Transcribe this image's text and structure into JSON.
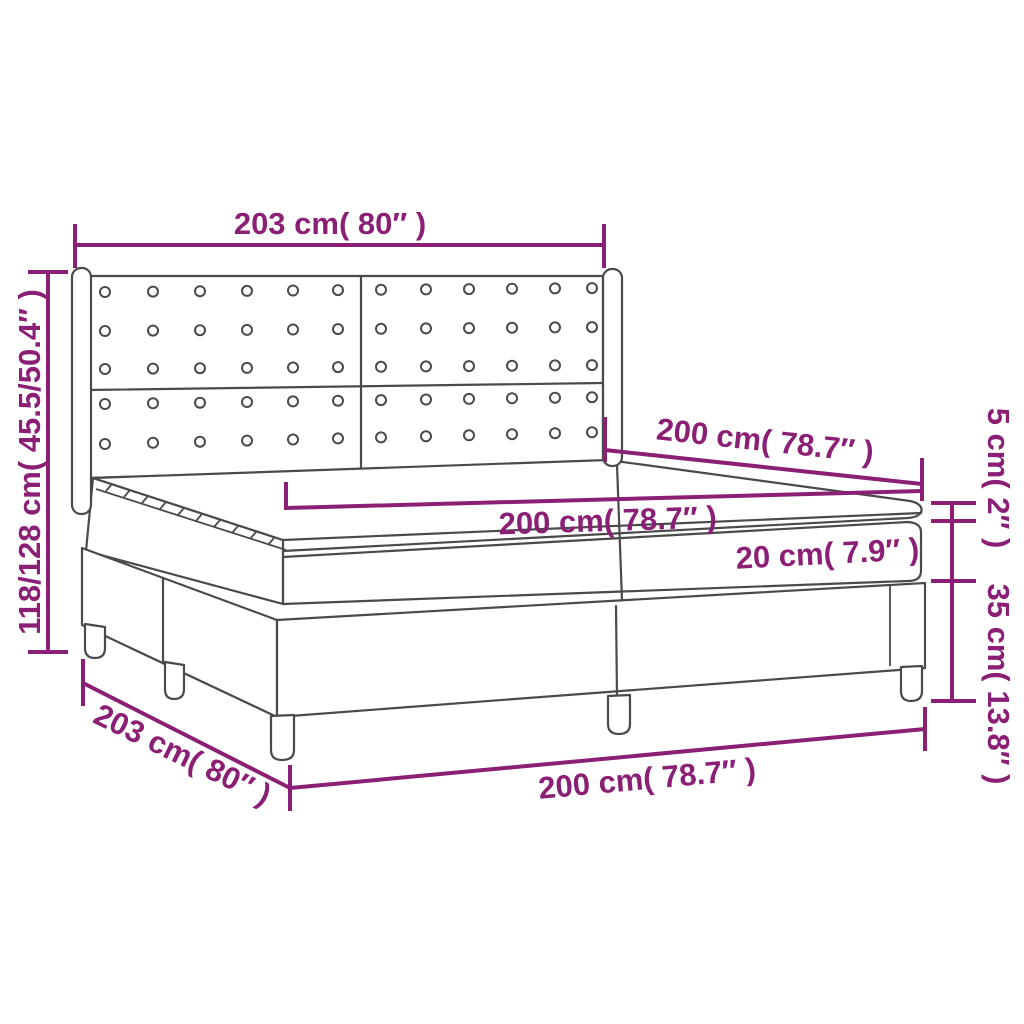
{
  "figure": {
    "title": "box-spring-bed-dimension-diagram",
    "background": "#FFFFFF"
  },
  "colors": {
    "dimension_accent": "#8B1F75",
    "drawing_outline": "#4A4A4A"
  },
  "labels": {
    "headboard_width": "203 cm( 80″ )",
    "bed_height": "118/128 cm( 45.5/50.4″ )",
    "mattress_length": "200 cm( 78.7″ )",
    "mattress_width": "200 cm( 78.7″ )",
    "mattress_thickness": "20 cm( 7.9″ )",
    "topper_thickness": "5 cm( 2″ )",
    "base_height": "35 cm( 13.8″ )",
    "bed_length": "203 cm( 80″ )",
    "bed_width": "200 cm( 78.7″ )"
  }
}
